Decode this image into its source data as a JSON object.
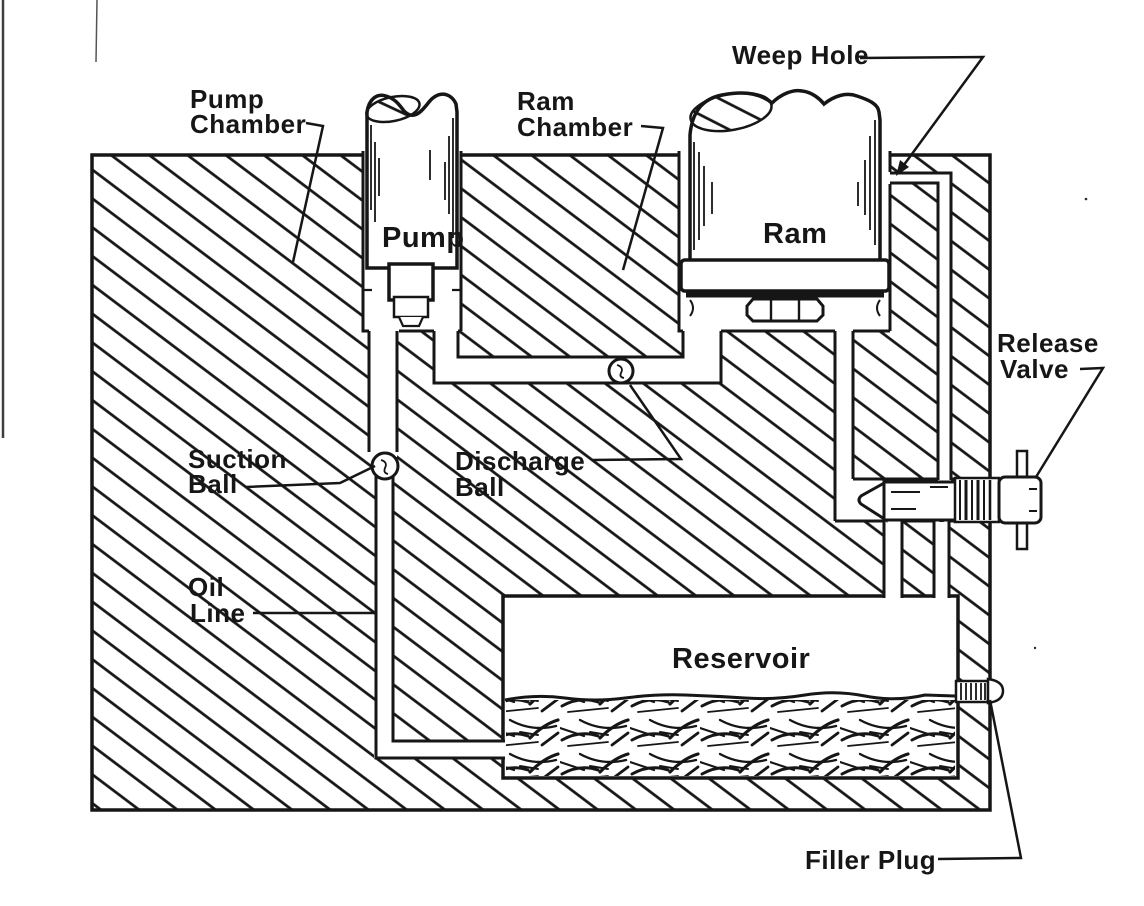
{
  "diagram": {
    "type": "technical-cutaway",
    "subject": "hydraulic jack cross-section",
    "colors": {
      "ink": "#161616",
      "paper": "#ffffff"
    },
    "part_labels": {
      "pump": "Pump",
      "ram": "Ram",
      "reservoir": "Reservoir"
    },
    "callouts": {
      "pump_chamber": {
        "line1": "Pump",
        "line2": "Chamber"
      },
      "ram_chamber": {
        "line1": "Ram",
        "line2": "Chamber"
      },
      "weep_hole": {
        "line1": "Weep Hole"
      },
      "release_valve": {
        "line1": "Release",
        "line2": "Valve"
      },
      "suction_ball": {
        "line1": "Suction",
        "line2": "Ball"
      },
      "discharge_ball": {
        "line1": "Discharge",
        "line2": "Ball"
      },
      "oil_line": {
        "line1": "Oil",
        "line2": "Line"
      },
      "filler_plug": {
        "line1": "Filler Plug"
      }
    }
  }
}
